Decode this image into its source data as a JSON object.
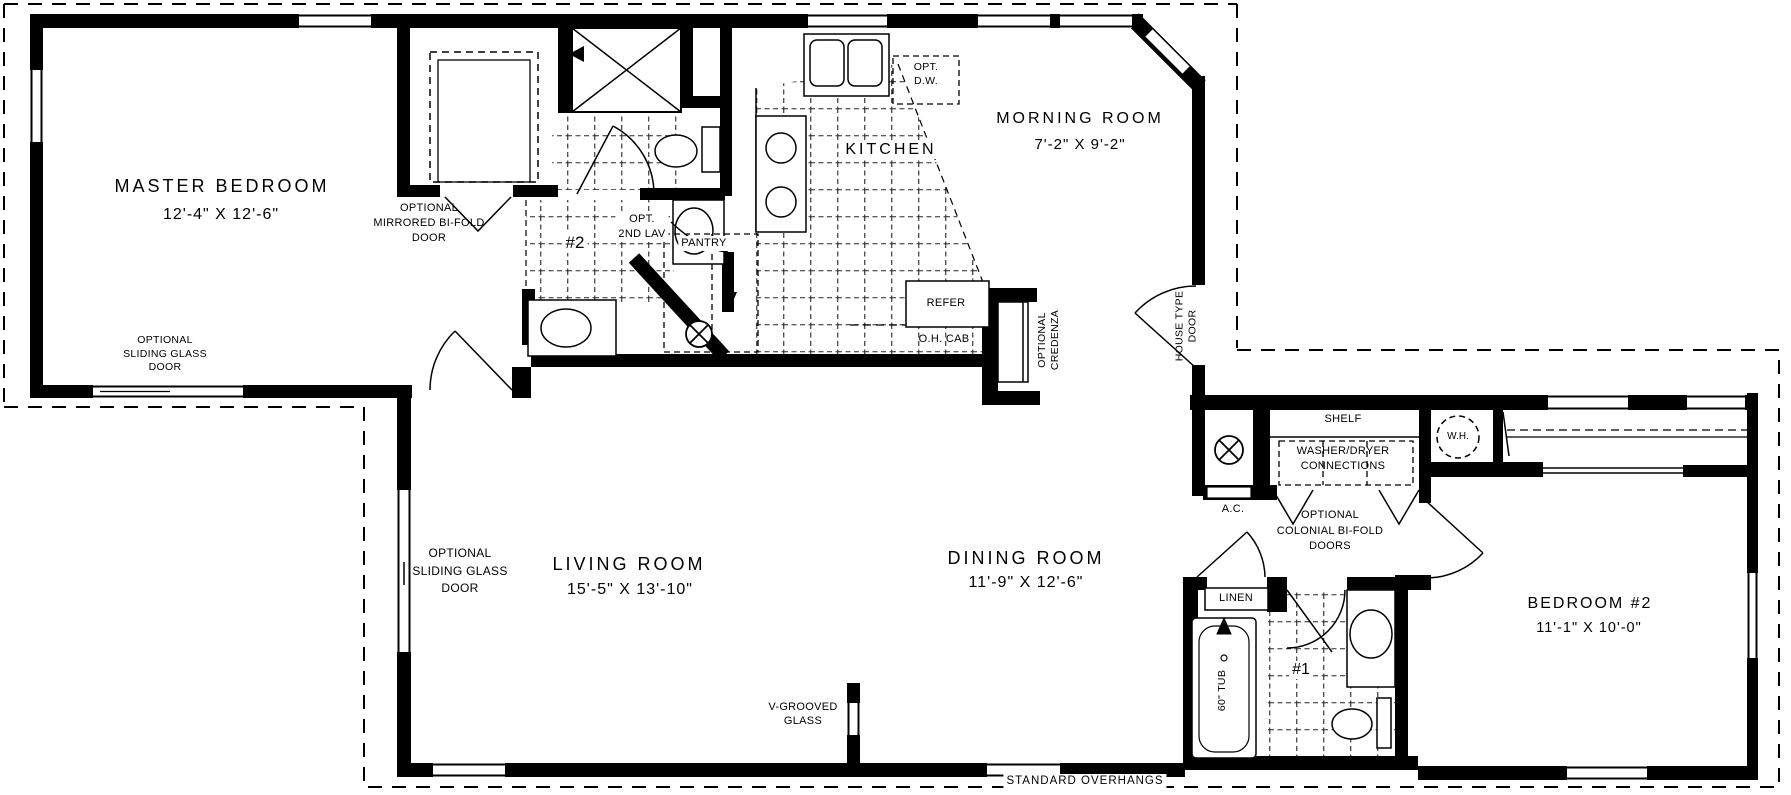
{
  "rooms": {
    "master_bedroom": {
      "name": "MASTER BEDROOM",
      "dims": "12'-4\" X 12'-6\""
    },
    "morning_room": {
      "name": "MORNING ROOM",
      "dims": "7'-2\" X 9'-2\""
    },
    "kitchen": {
      "name": "KITCHEN"
    },
    "living_room": {
      "name": "LIVING ROOM",
      "dims": "15'-5\" X 13'-10\""
    },
    "dining_room": {
      "name": "DINING ROOM",
      "dims": "11'-9\" X 12'-6\""
    },
    "bedroom_2": {
      "name": "BEDROOM #2",
      "dims": "11'-1\" X 10'-0\""
    },
    "bath_1": {
      "name": "#1"
    },
    "bath_2": {
      "name": "#2"
    }
  },
  "labels": {
    "optional_mirrored_bifold_door": "OPTIONAL\nMIRRORED BI-FOLD\nDOOR",
    "optional_sliding_glass_door_master": "OPTIONAL\nSLIDING GLASS\nDOOR",
    "optional_sliding_glass_door_living": "OPTIONAL\nSLIDING GLASS\nDOOR",
    "opt_2nd_lav": "OPT.\n2ND LAV",
    "opt_dw": "OPT.\nD.W.",
    "pantry": "PANTRY",
    "refer": "REFER",
    "oh_cab": "O.H. CAB",
    "optional_credenza": "OPTIONAL\nCREDENZA",
    "house_type_door": "HOUSE TYPE\nDOOR",
    "shelf": "SHELF",
    "washer_dryer_connections": "WASHER/DRYER\nCONNECTIONS",
    "optional_colonial_bifold_doors": "OPTIONAL\nCOLONIAL BI-FOLD\nDOORS",
    "wh": "W.H.",
    "ac": "A.C.",
    "linen": "LINEN",
    "tub_60": "60\" TUB",
    "v_grooved_glass": "V-GROOVED\nGLASS",
    "standard_overhangs": "STANDARD OVERHANGS"
  },
  "symbols": {
    "ceiling_fixture": "circle-x",
    "water_heater": "dashed-circle",
    "shower": "x-box",
    "bifold_door": "v-lines",
    "overhang_line": "dashed"
  },
  "colors": {
    "line": "#000000",
    "background": "#ffffff"
  }
}
